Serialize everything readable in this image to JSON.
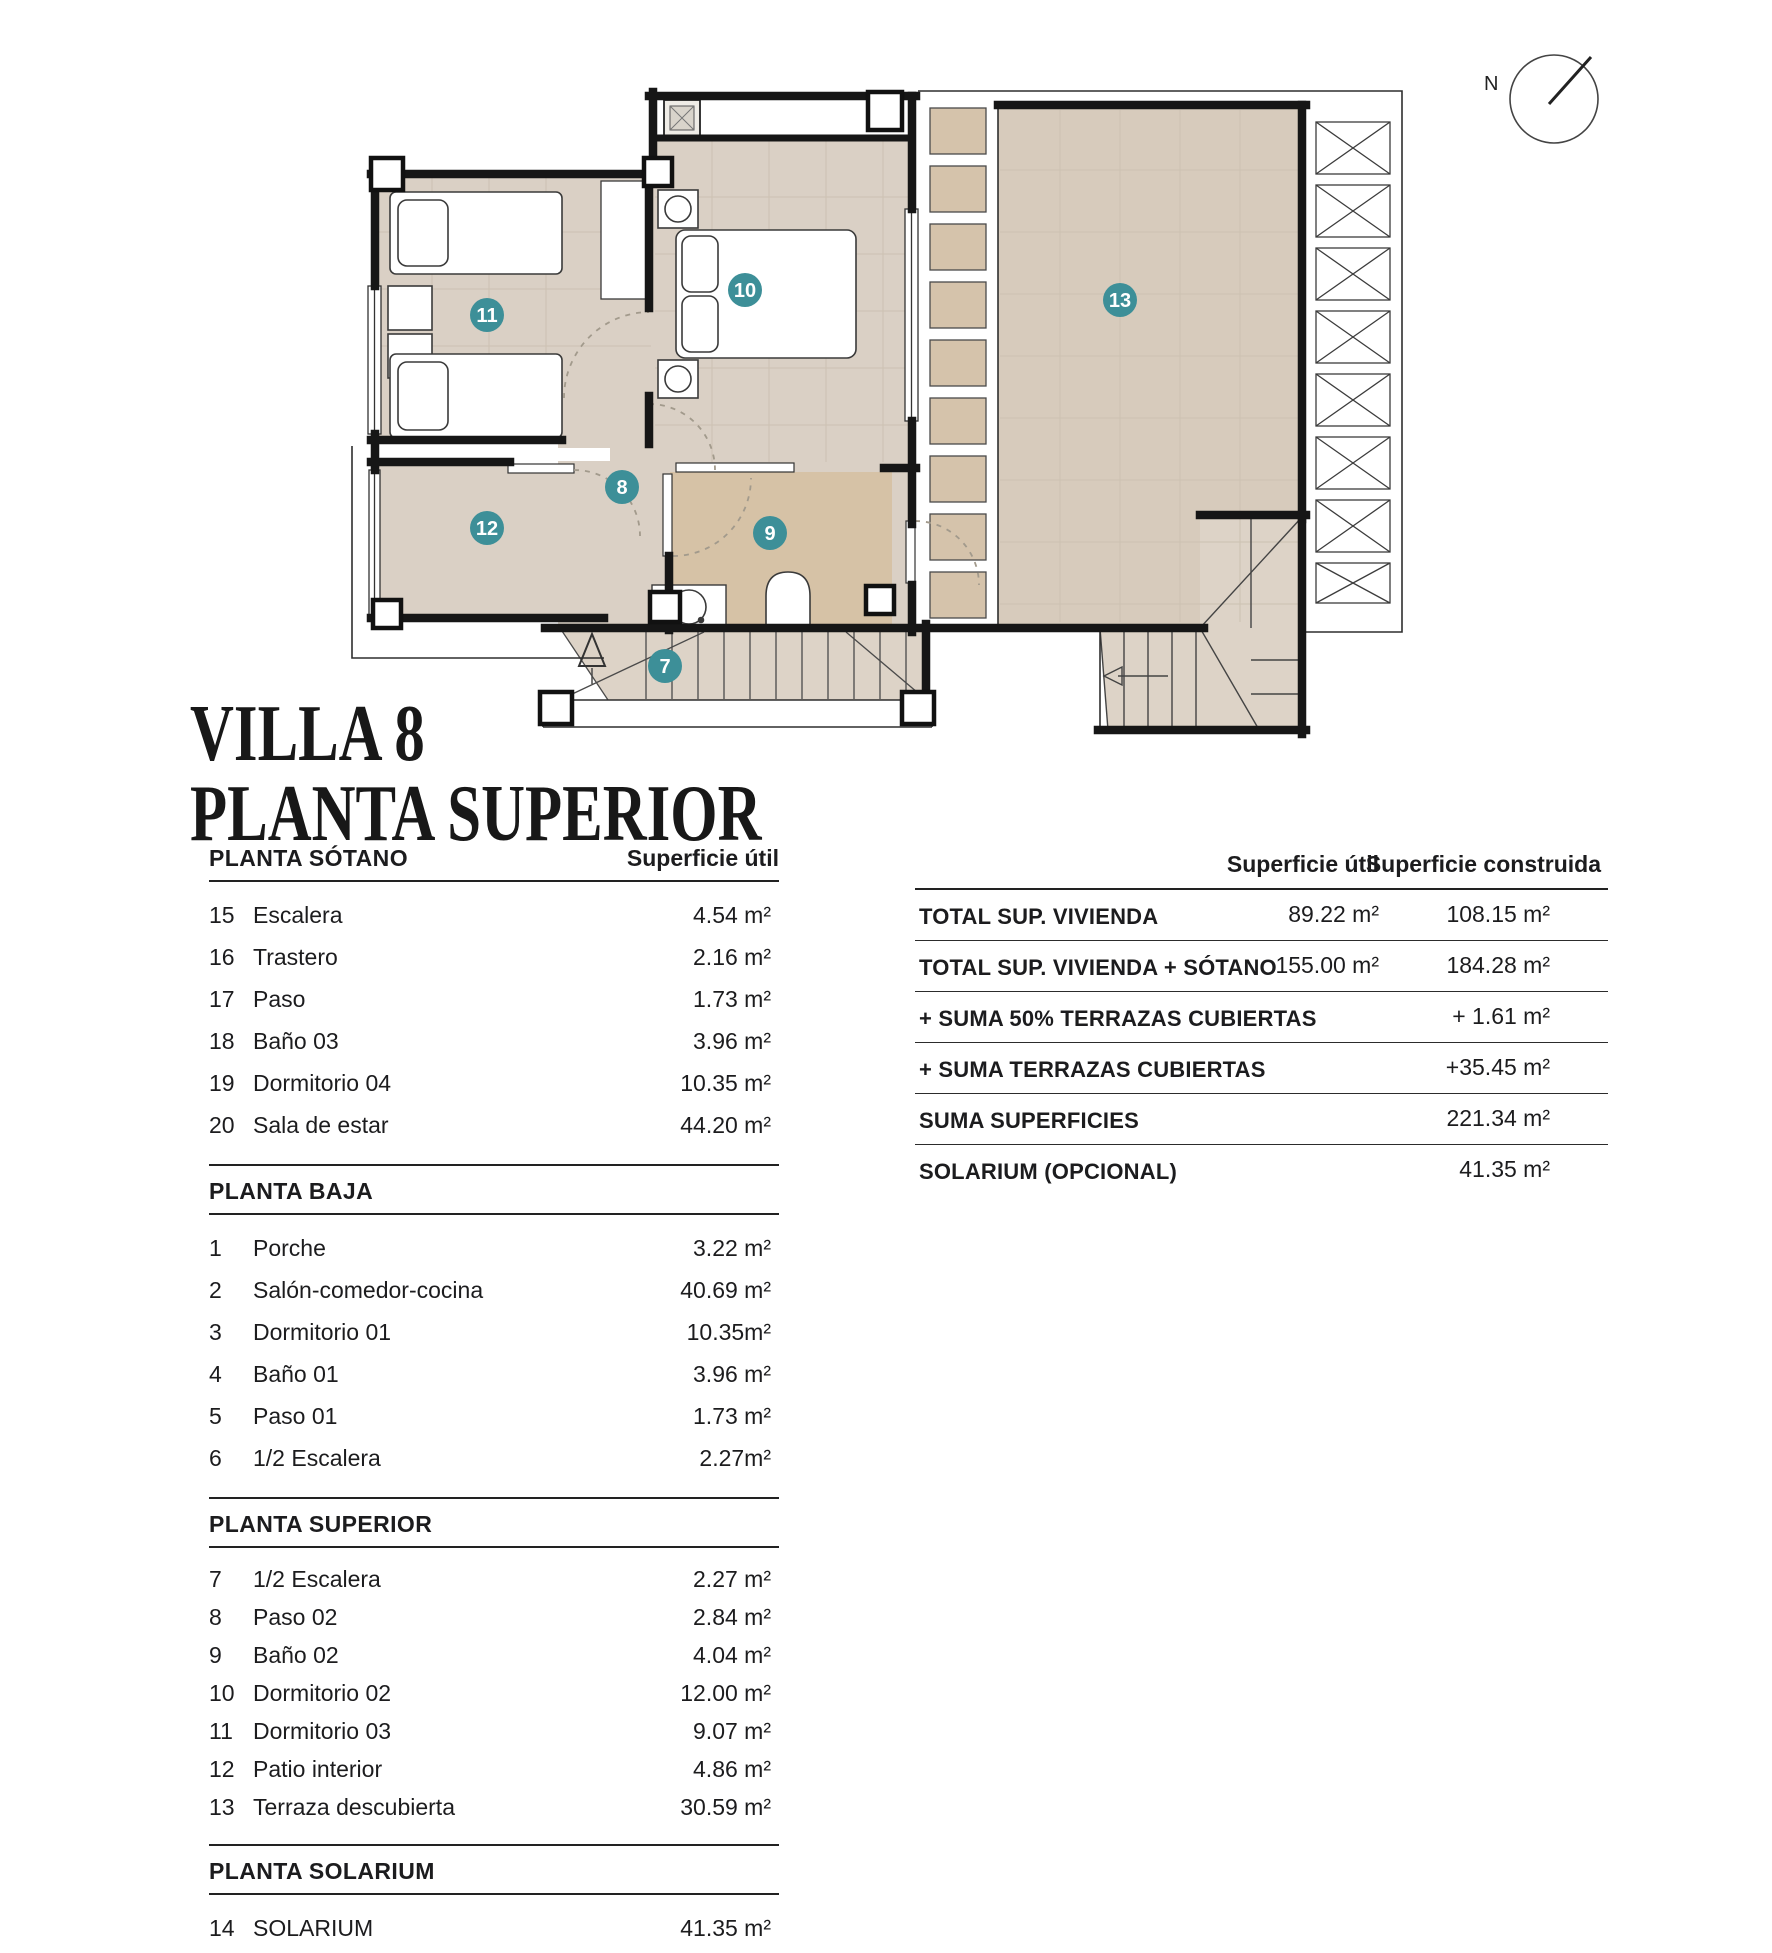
{
  "title": {
    "line1": "VILLA 8",
    "line2": "PLANTA SUPERIOR"
  },
  "left_table": {
    "area_header": "Superficie útil",
    "sections": [
      {
        "header": "PLANTA SÓTANO",
        "rows": [
          [
            "15",
            "Escalera",
            "4.54 m²"
          ],
          [
            "16",
            "Trastero",
            "2.16 m²"
          ],
          [
            "17",
            "Paso",
            "1.73 m²"
          ],
          [
            "18",
            "Baño 03",
            "3.96 m²"
          ],
          [
            "19",
            "Dormitorio 04",
            "10.35 m²"
          ],
          [
            "20",
            "Sala de estar",
            "44.20 m²"
          ]
        ]
      },
      {
        "header": "PLANTA BAJA",
        "rows": [
          [
            "1",
            "Porche",
            "3.22 m²"
          ],
          [
            "2",
            "Salón-comedor-cocina",
            "40.69 m²"
          ],
          [
            "3",
            "Dormitorio 01",
            "10.35m²"
          ],
          [
            "4",
            "Baño 01",
            "3.96 m²"
          ],
          [
            "5",
            "Paso 01",
            "1.73 m²"
          ],
          [
            "6",
            "1/2 Escalera",
            "2.27m²"
          ]
        ]
      },
      {
        "header": "PLANTA SUPERIOR",
        "rows": [
          [
            "7",
            "1/2 Escalera",
            "2.27 m²"
          ],
          [
            "8",
            "Paso 02",
            "2.84 m²"
          ],
          [
            "9",
            "Baño 02",
            "4.04 m²"
          ],
          [
            "10",
            "Dormitorio 02",
            "12.00 m²"
          ],
          [
            "11",
            "Dormitorio 03",
            "9.07 m²"
          ],
          [
            "12",
            "Patio interior",
            "4.86 m²"
          ],
          [
            "13",
            "Terraza descubierta",
            "30.59 m²"
          ]
        ]
      },
      {
        "header": "PLANTA SOLARIUM",
        "rows": [
          [
            "14",
            "SOLARIUM",
            "41.35 m²"
          ]
        ]
      }
    ]
  },
  "summary_table": {
    "col1_header": "Superficie útil",
    "col2_header": "Superficie construida",
    "rows": [
      {
        "label": "TOTAL SUP. VIVIENDA",
        "util": "89.22 m²",
        "construida": "108.15 m²"
      },
      {
        "label": "TOTAL SUP. VIVIENDA + SÓTANO",
        "util": "155.00  m²",
        "construida": "184.28 m²"
      },
      {
        "label": "+ SUMA 50% TERRAZAS CUBIERTAS",
        "util": "",
        "construida": "+ 1.61 m²"
      },
      {
        "label": "+ SUMA TERRAZAS CUBIERTAS",
        "util": "",
        "construida": "+35.45 m²"
      },
      {
        "label": "SUMA SUPERFICIES",
        "util": "",
        "construida": "221.34 m²"
      },
      {
        "label": "SOLARIUM (OPCIONAL)",
        "util": "",
        "construida": "41.35 m²"
      }
    ]
  },
  "plan": {
    "compass_label": "N",
    "markers": [
      {
        "num": "10",
        "x": 745,
        "y": 290
      },
      {
        "num": "11",
        "x": 487,
        "y": 315
      },
      {
        "num": "13",
        "x": 1120,
        "y": 300
      },
      {
        "num": "8",
        "x": 622,
        "y": 487
      },
      {
        "num": "9",
        "x": 770,
        "y": 533
      },
      {
        "num": "12",
        "x": 487,
        "y": 528
      },
      {
        "num": "7",
        "x": 665,
        "y": 666
      }
    ],
    "colors": {
      "marker_teal": "#3d8f98",
      "floor": "#dad0c5",
      "floor_dark": "#d6c2a6",
      "terrace": "#d7cbbc",
      "slat": "#d5c3ab",
      "stair": "#ddd3c7",
      "wall": "#161616"
    }
  }
}
